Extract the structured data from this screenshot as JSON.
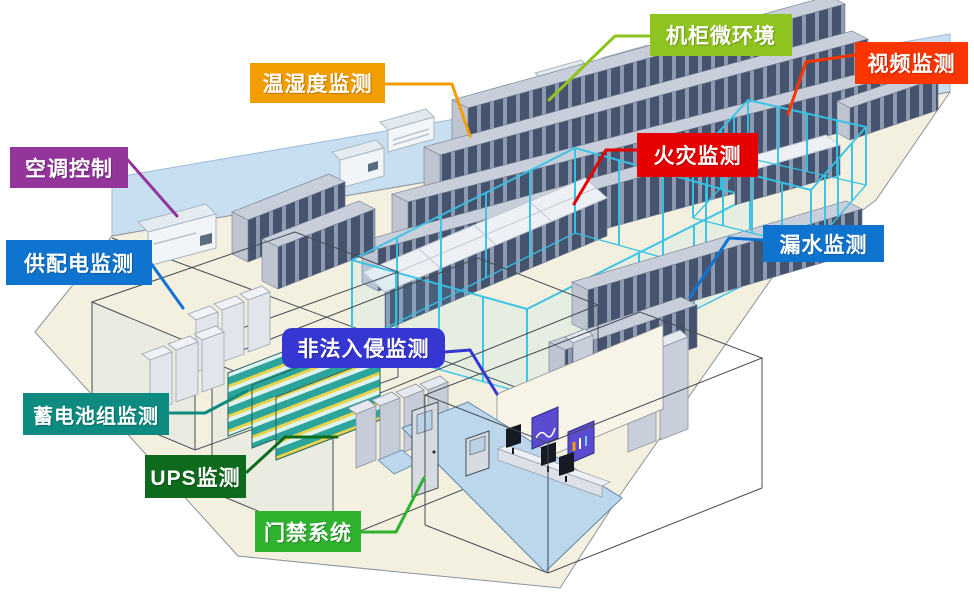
{
  "labels": [
    {
      "id": "cabinet-microenvironment",
      "text": "机柜微环境",
      "color": "#8FC31F"
    },
    {
      "id": "video-monitoring",
      "text": "视频监测",
      "color": "#FB3500"
    },
    {
      "id": "temperature-humidity",
      "text": "温湿度监测",
      "color": "#F29D00"
    },
    {
      "id": "fire-monitoring",
      "text": "火灾监测",
      "color": "#E60000"
    },
    {
      "id": "ac-control",
      "text": "空调控制",
      "color": "#93359B"
    },
    {
      "id": "power-distribution",
      "text": "供配电监测",
      "color": "#0F74D0"
    },
    {
      "id": "water-leak",
      "text": "漏水监测",
      "color": "#0F74D0"
    },
    {
      "id": "intrusion-monitoring",
      "text": "非法入侵监测",
      "color": "#3636D2"
    },
    {
      "id": "battery-monitoring",
      "text": "蓄电池组监测",
      "color": "#0D8B80"
    },
    {
      "id": "ups-monitoring",
      "text": "UPS监测",
      "color": "#0E6B1D"
    },
    {
      "id": "access-control",
      "text": "门禁系统",
      "color": "#2FB32F"
    }
  ],
  "scene": {
    "floor_color": "#F3F0E0",
    "wall_color": "#C7DFF0",
    "cage_fence_color": "#35C3E6",
    "rack_front_color": "#46536E",
    "rack_stripe_color": "#8E9AB0",
    "rack_top_color": "#C9CFDA",
    "battery_shelf_color": "#2BA49B",
    "battery_trim_color": "#E8D44D",
    "control_room_floor_color": "#BCD7EC",
    "wall_screen_color": "#5B4BD0"
  }
}
